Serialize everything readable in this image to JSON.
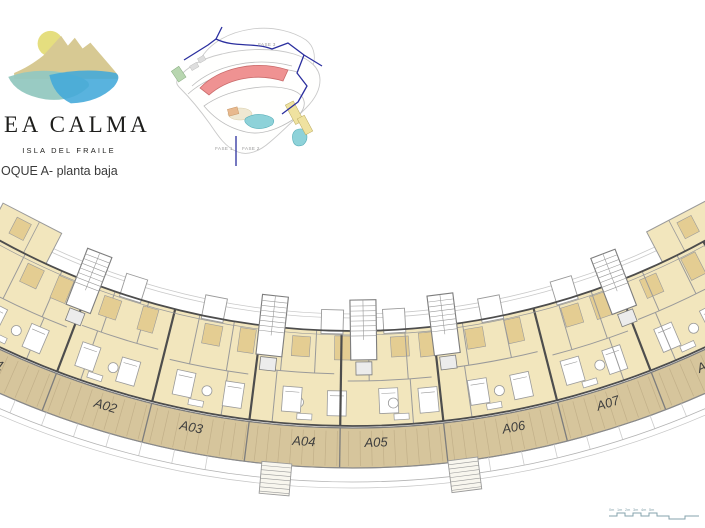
{
  "header": {
    "brand_name": "SEA CALMA",
    "brand_subtitle": "ISLA DEL FRAILE",
    "plan_title": "OQUE A- planta baja"
  },
  "site_map": {
    "labels": {
      "fase3": "FASE 3",
      "fase1": "FASE 1",
      "fase2": "FASE 2"
    },
    "colors": {
      "boundary": "#2b2f9f",
      "highlight_fill": "#ef9292",
      "highlight_stroke": "#c96a6a",
      "pool": "#8ed2d9",
      "terrain": "#c9c9c9",
      "road": "#bdbdbd",
      "yellow_building": "#efe2a0",
      "green_building": "#b8d6b0",
      "peach_building": "#e8b98e"
    }
  },
  "logo_colors": {
    "sun": "#e5de7f",
    "mountain": "#d7c993",
    "water_left": "#94c8c0",
    "water_right": "#42a8da"
  },
  "floorplan": {
    "units": [
      {
        "label": "A01",
        "angle": -25.2
      },
      {
        "label": "A02",
        "angle": -17.0
      },
      {
        "label": "A03",
        "angle": -11.0
      },
      {
        "label": "A04",
        "angle": -3.3
      },
      {
        "label": "A05",
        "angle": 1.6
      },
      {
        "label": "A06",
        "angle": 11.0
      },
      {
        "label": "A07",
        "angle": 17.6
      },
      {
        "label": "A08",
        "angle": 24.9
      }
    ],
    "boundaries": [
      -28.8,
      -20.9,
      -14.0,
      -7.15,
      -0.85,
      6.3,
      14.3,
      21.1,
      28.6
    ],
    "stair_boundary_indexes": [
      1,
      3,
      4,
      5,
      7
    ],
    "exterior_stair_angles": [
      -7.3,
      5.0
    ],
    "geometry": {
      "cx": 352.5,
      "cy": -402,
      "r_rail1": 716,
      "r_rail2": 720,
      "r_outer": 733,
      "r_outer2": 737,
      "r_split": 783,
      "r_front": 828,
      "r_terrace_in": 830,
      "r_terrace_out": 870,
      "r_low1": 884,
      "r_low2": 890,
      "r_label": 849,
      "span": 30.5
    },
    "colors": {
      "room": "#f2e6bd",
      "room_dark": "#e4cd92",
      "terrace": "#d6c59c",
      "hatch": "#c2b089",
      "wall": "#4d4d4d",
      "wall_mid": "#7d7d7d",
      "wall_light": "#9a9a9a",
      "faint": "#c9c9c9",
      "label": "#3e3e3e"
    }
  },
  "scale_bar": {
    "labels": [
      "0m",
      "1m",
      "2m",
      "3m",
      "4m",
      "5m"
    ],
    "color": "#86a3ac"
  }
}
